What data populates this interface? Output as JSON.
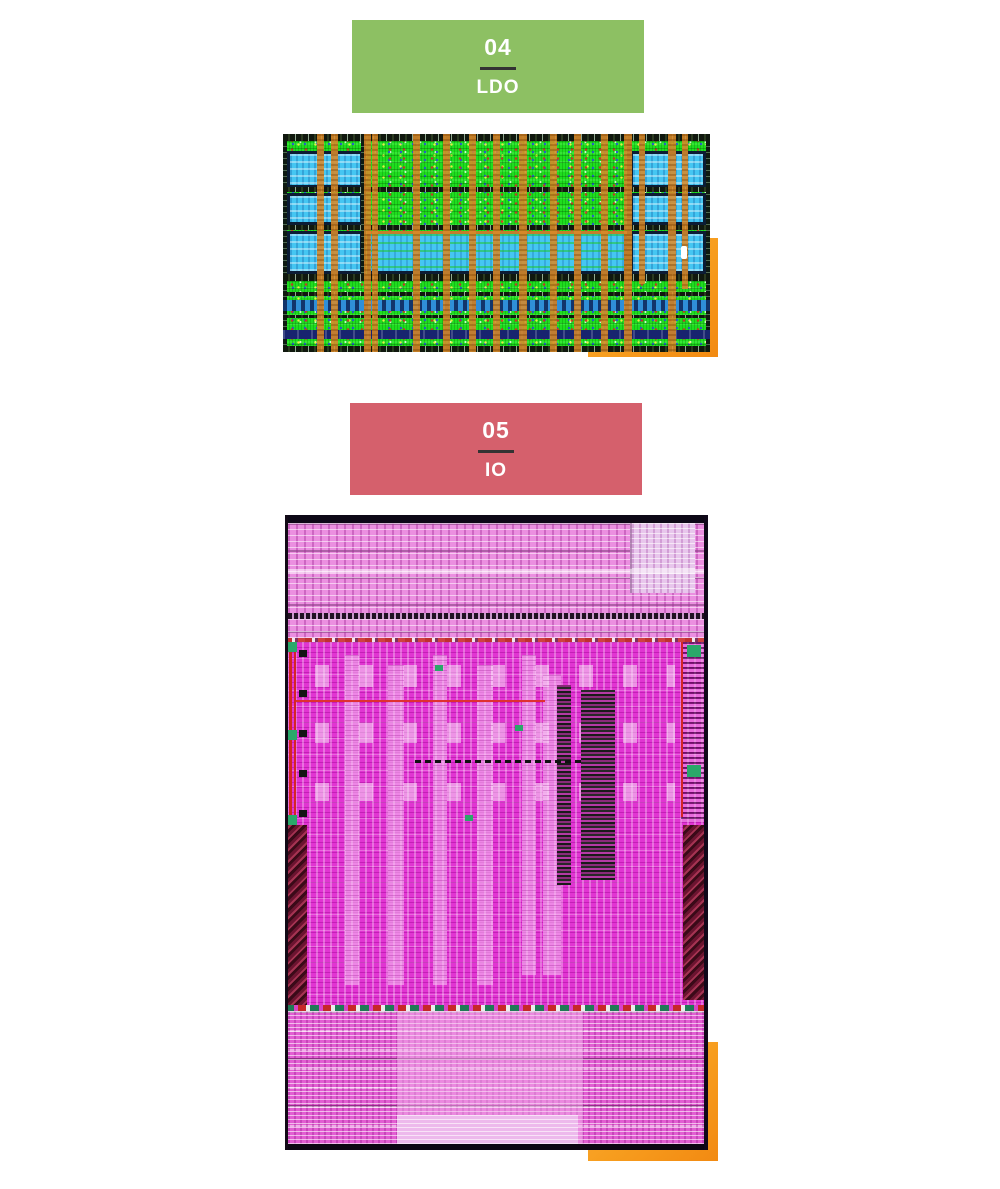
{
  "page": {
    "background": "#ffffff"
  },
  "sections": [
    {
      "number": "04",
      "title": "LDO",
      "header_bg": "#8dc063",
      "header_text_color": "#ffffff",
      "divider_color": "#333333",
      "accent_color": "#f79d1e",
      "figure": {
        "name": "ldo-chip-layout-screenshot",
        "dominant_colors": [
          "#1fdd1f",
          "#45c6f2",
          "#d88a2a",
          "#0c1c34"
        ]
      }
    },
    {
      "number": "05",
      "title": "IO",
      "header_bg": "#d5606c",
      "header_text_color": "#ffffff",
      "divider_color": "#333333",
      "accent_color": "#f79d1e",
      "figure": {
        "name": "io-chip-layout-screenshot",
        "dominant_colors": [
          "#e135d2",
          "#eb8fe0",
          "#6b1430",
          "#0d0816"
        ]
      }
    }
  ]
}
